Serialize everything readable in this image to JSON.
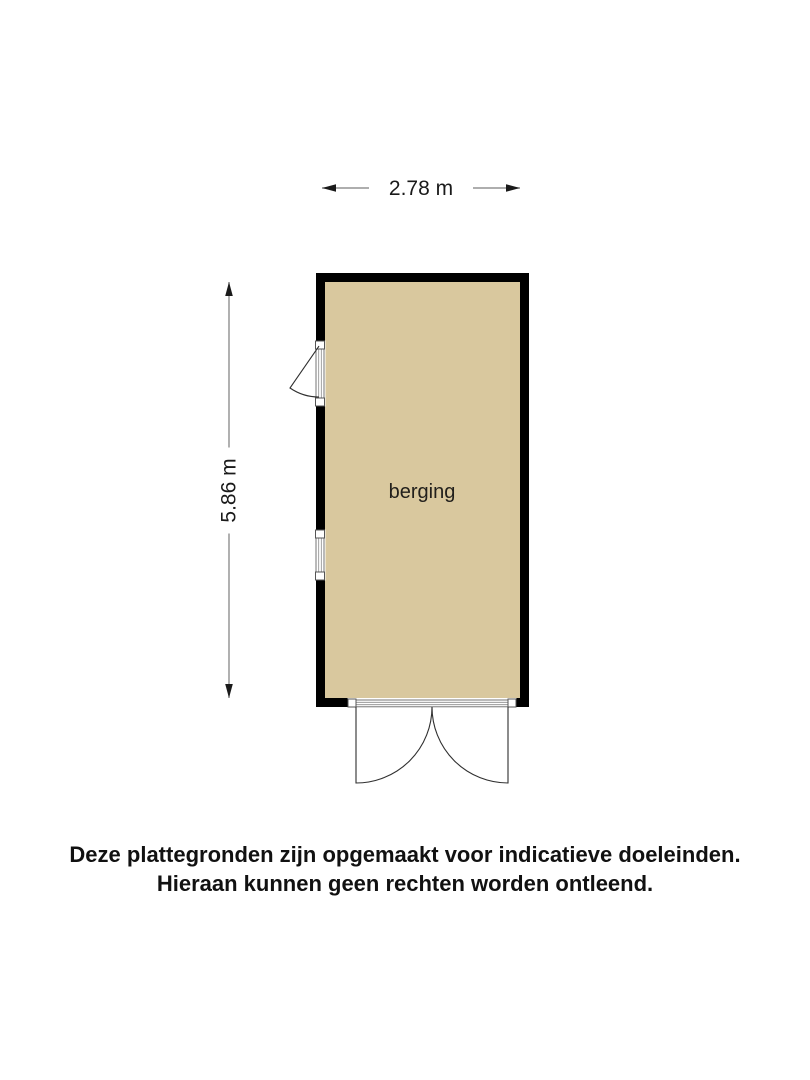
{
  "floor_plan": {
    "room": {
      "label": "berging",
      "fill_color": "#d9c89e"
    },
    "wall_color": "#000000",
    "dimensions": {
      "width_label": "2.78 m",
      "height_label": "5.86 m"
    },
    "features": {
      "left_door": "single door swinging outward on left wall",
      "left_window": "window on left wall",
      "bottom_doors": "double doors swinging outward on bottom wall"
    },
    "colors": {
      "dimension_line": "#7d7d7d",
      "arrowhead": "#1a1a1a",
      "swing_line": "#2f2f2f",
      "frame_line": "#666666"
    }
  },
  "disclaimer": {
    "line1": "Deze plattegronden zijn opgemaakt voor indicatieve doeleinden.",
    "line2": "Hieraan kunnen geen rechten worden ontleend."
  }
}
